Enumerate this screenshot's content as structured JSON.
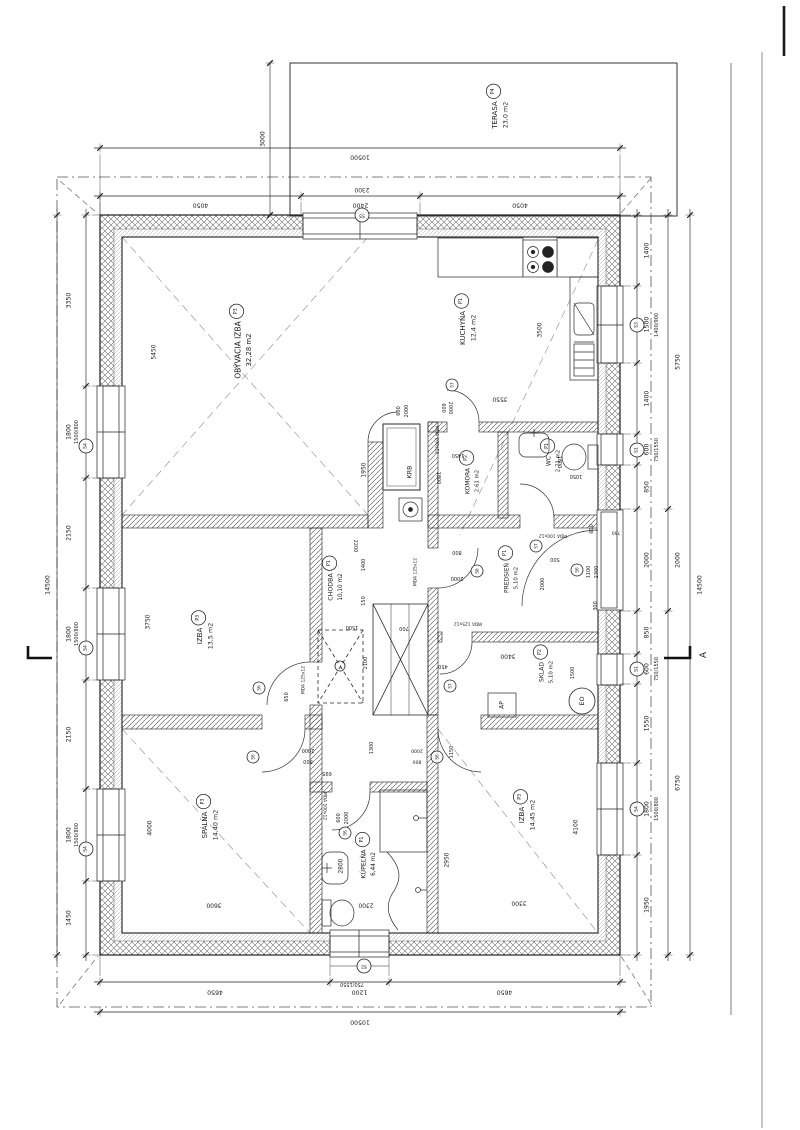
{
  "drawing": {
    "rooms": [
      {
        "id": "obyvacia",
        "name": "OBÝVACIA IZBA",
        "tag": "P3",
        "area": "32,28 m2"
      },
      {
        "id": "kuchyna",
        "name": "KUCHYŇA",
        "tag": "P1",
        "area": "12,4 m2"
      },
      {
        "id": "izba1",
        "name": "IZBA",
        "tag": "P3",
        "area": "13,5 m2"
      },
      {
        "id": "spalna",
        "name": "SPÁLŇA",
        "tag": "P3",
        "area": "14,40 m2"
      },
      {
        "id": "kupelna",
        "name": "KÚPEĽŇA",
        "tag": "P1",
        "area": "6,44 m2"
      },
      {
        "id": "izba2",
        "name": "IZBA",
        "tag": "P3",
        "area": "14,45 m2"
      },
      {
        "id": "chodba",
        "name": "CHODBA",
        "tag": "P1",
        "area": "10,10 m2"
      },
      {
        "id": "komora",
        "name": "KOMORA",
        "tag": "P2",
        "area": "2,61 m2"
      },
      {
        "id": "wc",
        "name": "WC",
        "tag": "P1",
        "area": "2,71 m2"
      },
      {
        "id": "predsien",
        "name": "PREDSIEŇ",
        "tag": "P1",
        "area": "5,10 m2"
      },
      {
        "id": "sklad",
        "name": "SKLAD",
        "tag": "P2",
        "area": "5,10 m2"
      },
      {
        "id": "terasa",
        "name": "TERASA",
        "tag": "P4",
        "area": "23,0 m2"
      },
      {
        "id": "krb",
        "name": "KRB"
      }
    ],
    "dim_chains": {
      "top_total": [
        "10500"
      ],
      "top_chain": [
        "4050",
        "2400",
        "4050"
      ],
      "bot_chain": [
        "4650",
        "1200",
        "4650"
      ],
      "bot_total": [
        "10500"
      ],
      "left_total": [
        "14500"
      ],
      "left_chain": [
        "3350",
        "1800",
        "2150",
        "1800",
        "2150",
        "1800",
        "1450"
      ],
      "right_chain": [
        "1400",
        "1500",
        "1400",
        "600",
        "850",
        "2000",
        "850",
        "600",
        "1550",
        "1800",
        "1950"
      ],
      "right_sub": [
        "5750",
        "2000",
        "6750"
      ],
      "right_total": [
        "14500"
      ],
      "terasa_depth": [
        "3000"
      ]
    },
    "dim_texts": [
      {
        "id": "w2300",
        "t": "2300"
      },
      {
        "id": "wl1",
        "t": "1500/800"
      },
      {
        "id": "wl2",
        "t": "1500/800"
      },
      {
        "id": "wl3",
        "t": "1500/800"
      },
      {
        "id": "wr1",
        "t": "1400/900"
      },
      {
        "id": "wr2",
        "t": "750/1550"
      },
      {
        "id": "wr3",
        "t": "750/1550"
      },
      {
        "id": "wr4",
        "t": "1500/800"
      },
      {
        "id": "wb1",
        "t": "750/1550"
      },
      {
        "id": "d5450",
        "t": "5450"
      },
      {
        "id": "d1950",
        "t": "1950"
      },
      {
        "id": "d3500",
        "t": "3500"
      },
      {
        "id": "d3550",
        "t": "3550"
      },
      {
        "id": "d600a",
        "t": "600"
      },
      {
        "id": "d2000a",
        "t": "2000"
      },
      {
        "id": "d600b",
        "t": "600"
      },
      {
        "id": "d2000b",
        "t": "2000"
      },
      {
        "id": "mda1",
        "t": "MDA 100x12"
      },
      {
        "id": "d1450",
        "t": "1450"
      },
      {
        "id": "d1800k",
        "t": "1800"
      },
      {
        "id": "d1800w",
        "t": "1800"
      },
      {
        "id": "d1050",
        "t": "1050"
      },
      {
        "id": "mda2",
        "t": "MDA 100x12"
      },
      {
        "id": "d2200",
        "t": "2200"
      },
      {
        "id": "d1400c",
        "t": "1400"
      },
      {
        "id": "d150",
        "t": "150"
      },
      {
        "id": "d800p",
        "t": "800"
      },
      {
        "id": "d2000p",
        "t": "2000"
      },
      {
        "id": "d500",
        "t": "500"
      },
      {
        "id": "d2000e",
        "t": "2000"
      },
      {
        "id": "d1100",
        "t": "1100"
      },
      {
        "id": "d2300p",
        "t": "2300"
      },
      {
        "id": "d600p",
        "t": "600"
      },
      {
        "id": "d750p",
        "t": "750"
      },
      {
        "id": "d300",
        "t": "300"
      },
      {
        "id": "mda3",
        "t": "MDA 125x12"
      },
      {
        "id": "d1500c",
        "t": "1500"
      },
      {
        "id": "d2100",
        "t": "2100"
      },
      {
        "id": "d700",
        "t": "700"
      },
      {
        "id": "mda4",
        "t": "MDA 125x12"
      },
      {
        "id": "d3400",
        "t": "3400"
      },
      {
        "id": "d450",
        "t": "450"
      },
      {
        "id": "d1500s",
        "t": "1500"
      },
      {
        "id": "d1300",
        "t": "1300"
      },
      {
        "id": "d695",
        "t": "695"
      },
      {
        "id": "d2000sp",
        "t": "2000"
      },
      {
        "id": "d800sp",
        "t": "800"
      },
      {
        "id": "mda5",
        "t": "MDA 125x12"
      },
      {
        "id": "d650",
        "t": "650"
      },
      {
        "id": "d1150",
        "t": "1150"
      },
      {
        "id": "d2000iz",
        "t": "2000"
      },
      {
        "id": "d800iz",
        "t": "800"
      },
      {
        "id": "d600k",
        "t": "600"
      },
      {
        "id": "d2000k",
        "t": "2000"
      },
      {
        "id": "mda6",
        "t": "MDA 100x12"
      },
      {
        "id": "d2800",
        "t": "2800"
      },
      {
        "id": "d2300b",
        "t": "2300"
      },
      {
        "id": "d3600",
        "t": "3600"
      },
      {
        "id": "d3750",
        "t": "3750"
      },
      {
        "id": "d4000",
        "t": "4000"
      },
      {
        "id": "d2950",
        "t": "2950"
      },
      {
        "id": "d4100",
        "t": "4100"
      },
      {
        "id": "d3300",
        "t": "3300"
      },
      {
        "id": "ap",
        "t": "AP"
      },
      {
        "id": "seca",
        "t": "A"
      }
    ],
    "marks": [
      {
        "id": "s5",
        "t": "S5"
      },
      {
        "id": "s3",
        "t": "S3"
      },
      {
        "id": "s1a",
        "t": "S1"
      },
      {
        "id": "s1b",
        "t": "S1"
      },
      {
        "id": "s4r",
        "t": "S4"
      },
      {
        "id": "s4l1",
        "t": "S4"
      },
      {
        "id": "s4l2",
        "t": "S4"
      },
      {
        "id": "s4l3",
        "t": "S4"
      },
      {
        "id": "s2",
        "t": "S2"
      },
      {
        "id": "s7a",
        "t": "S7"
      },
      {
        "id": "s7b",
        "t": "S7"
      },
      {
        "id": "s7c",
        "t": "S7"
      },
      {
        "id": "s8a",
        "t": "S8"
      },
      {
        "id": "s6a",
        "t": "S6"
      },
      {
        "id": "s6b",
        "t": "S6"
      },
      {
        "id": "s6c",
        "t": "S6"
      },
      {
        "id": "s6d",
        "t": "S6"
      },
      {
        "id": "s6e",
        "t": "S6"
      },
      {
        "id": "eo",
        "t": "EO"
      }
    ]
  }
}
